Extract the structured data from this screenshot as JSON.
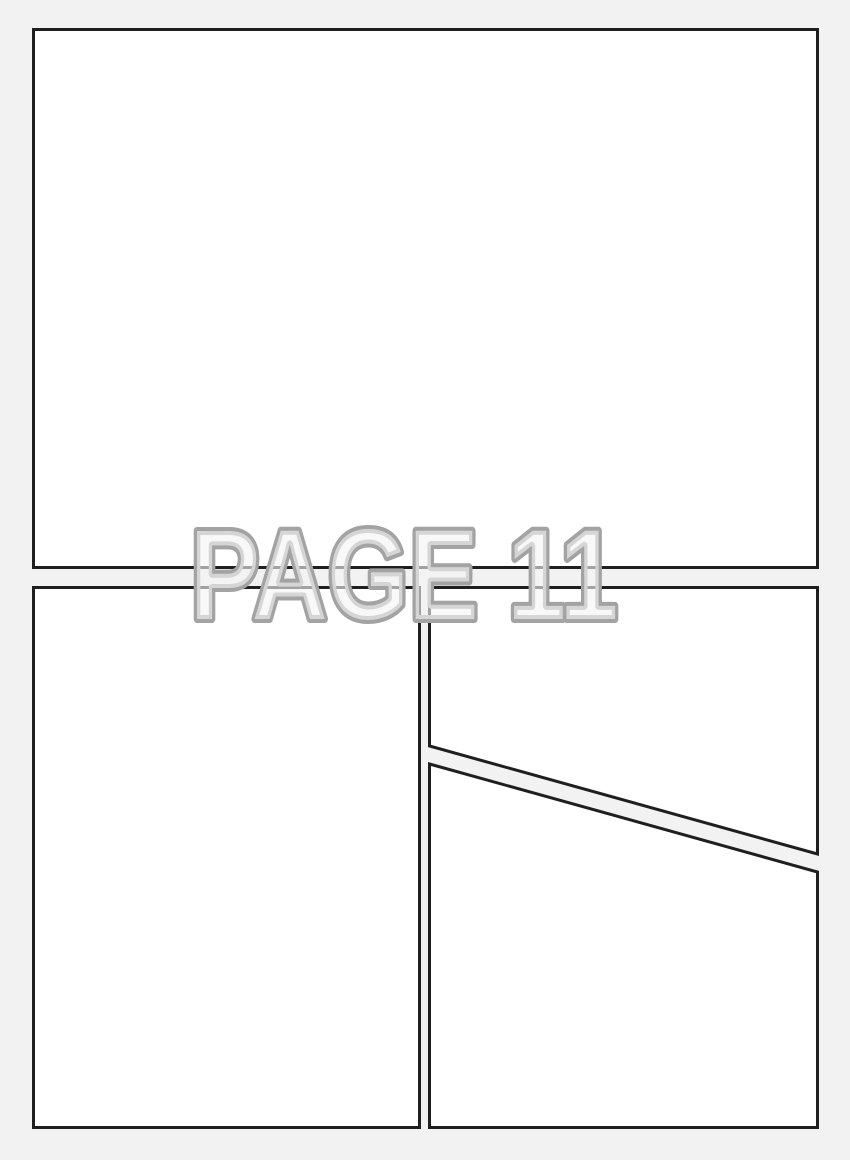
{
  "page": {
    "label": "PAGE 11",
    "type": "blank comic page panel template",
    "panel_count": 4,
    "colors": {
      "background": "#f2f2f2",
      "panel_fill": "#ffffff",
      "panel_border": "#1f1f1f",
      "label_outline": "#a3a3a3",
      "label_fill": "#f3f3f3"
    },
    "panels": [
      {
        "name": "panel-top",
        "shape": "rectangle",
        "position": "top, full width",
        "content": ""
      },
      {
        "name": "panel-bottom-left",
        "shape": "rectangle",
        "position": "bottom left",
        "content": ""
      },
      {
        "name": "panel-right-upper",
        "shape": "quadrilateral, slanted bottom edge",
        "position": "middle right",
        "content": ""
      },
      {
        "name": "panel-right-lower",
        "shape": "quadrilateral, slanted top edge",
        "position": "bottom right",
        "content": ""
      }
    ]
  }
}
